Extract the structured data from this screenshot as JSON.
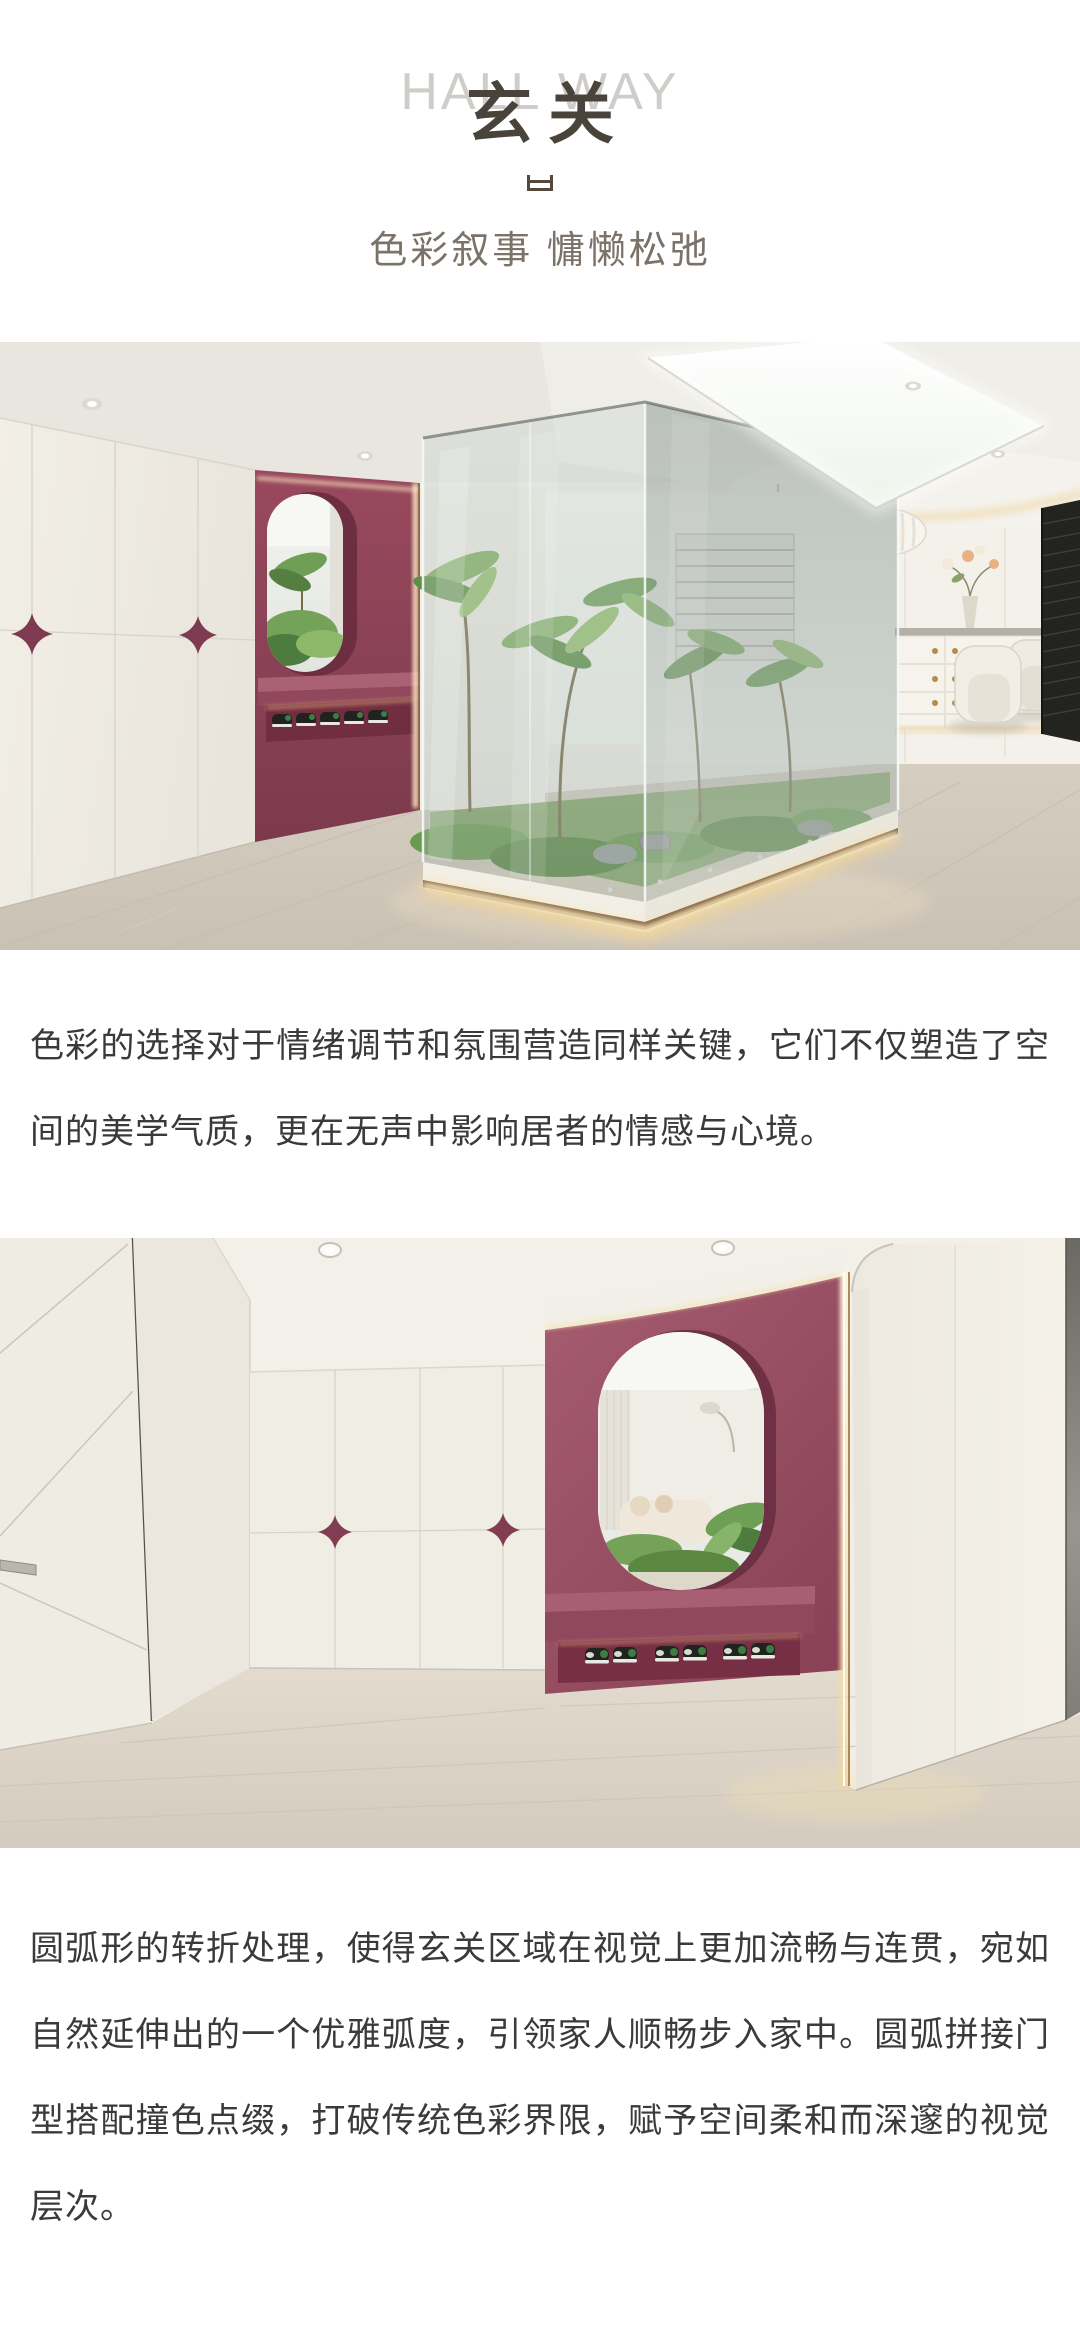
{
  "header": {
    "title_en": "HALL WAY",
    "title_cn": "玄关",
    "subtitle": "色彩叙事 慵懒松弛"
  },
  "paragraphs": [
    "色彩的选择对于情绪调节和氛围营造同样关键，它们不仅塑造了空间的美学气质，更在无声中影响居者的情感与心境。",
    "圆弧形的转折处理，使得玄关区域在视觉上更加流畅与连贯，宛如自然延伸出的一个优雅弧度，引领家人顺畅步入家中。圆弧拼接门型搭配撞色点缀，打破传统色彩界限，赋予空间柔和而深邃的视觉层次。"
  ],
  "photos": {
    "first": "hallway-glass-garden-photo",
    "second": "hallway-arched-entry-photo"
  },
  "colors": {
    "accent_burgundy": "#8d4156",
    "accent_rose": "#a05a6d",
    "cream": "#f0ede5",
    "watermark_gray": "#cfcdc9",
    "title_dark": "#4a433b",
    "subtitle_gray": "#7b7268",
    "body_text": "#3a3a3a"
  }
}
